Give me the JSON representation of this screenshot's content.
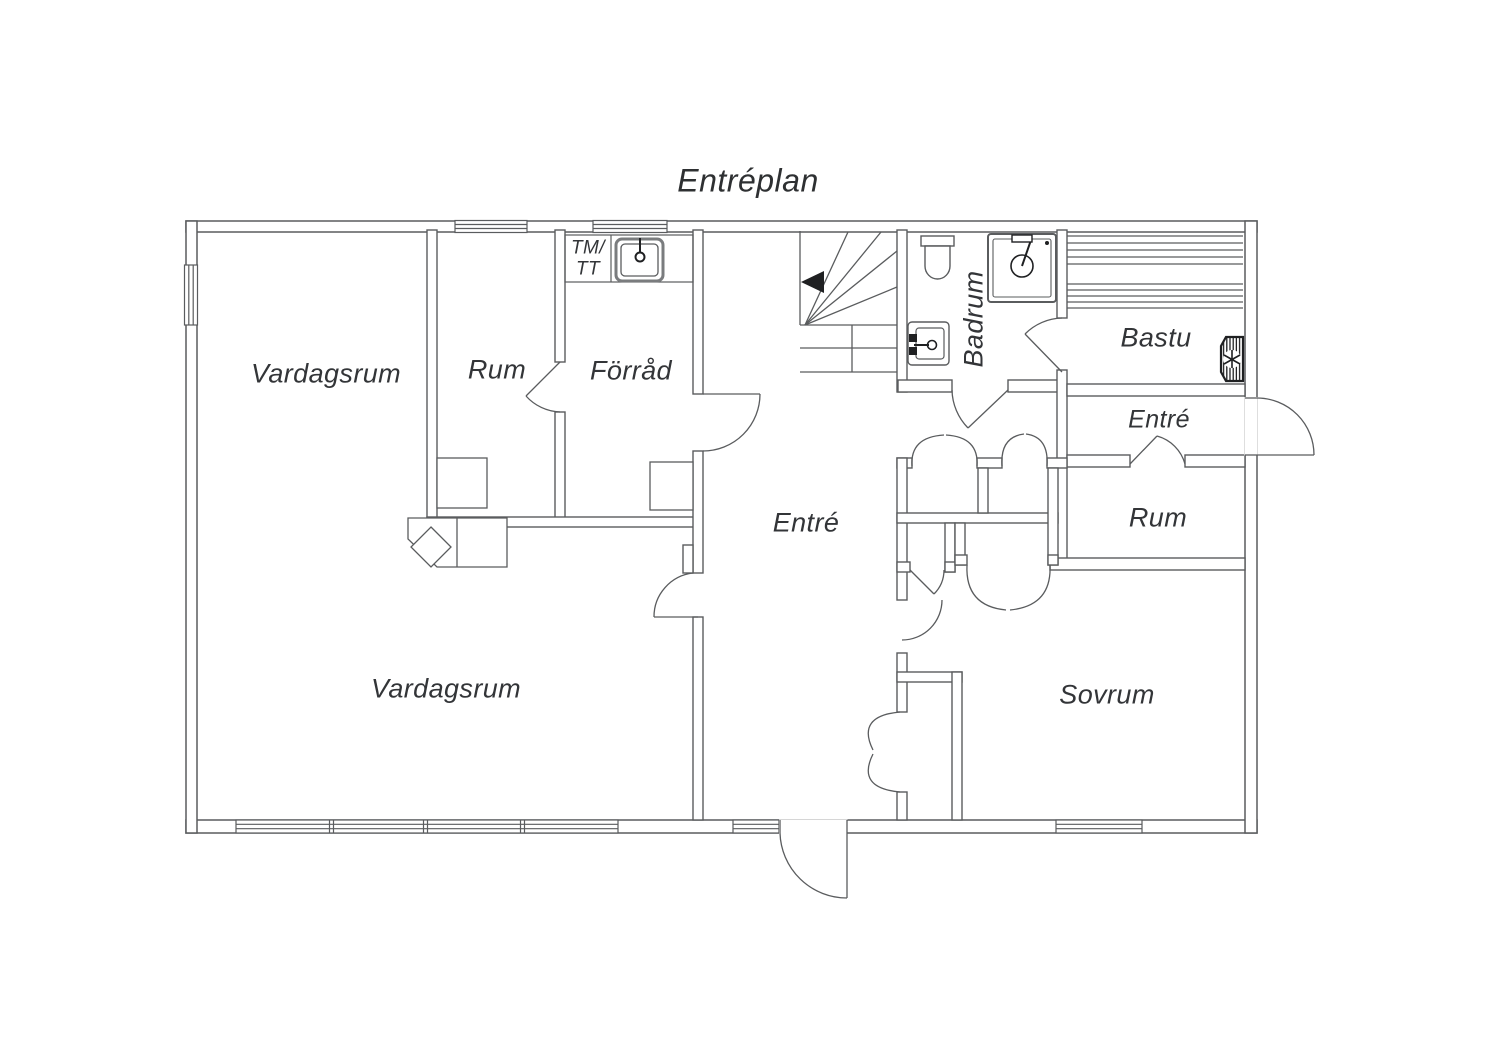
{
  "title": "Entréplan",
  "floor_plan": {
    "rooms": {
      "vardagsrum_upper": "Vardagsrum",
      "rum_upper": "Rum",
      "forrad": "Förråd",
      "tm_tt_line1": "TM/",
      "tm_tt_line2": "TT",
      "entre_main": "Entré",
      "badrum": "Badrum",
      "bastu": "Bastu",
      "entre_side": "Entré",
      "rum_side": "Rum",
      "vardagsrum_lower": "Vardagsrum",
      "sovrum": "Sovrum"
    },
    "fixtures": [
      "stairs",
      "stair-direction-arrow",
      "laundry-sink",
      "toilet",
      "shower",
      "washbasin",
      "sauna-benches",
      "sauna-heater",
      "fireplace",
      "closet-rum",
      "closet-forrad"
    ],
    "colors": {
      "wall_line": "#5a5c5e",
      "text": "#333538",
      "fixture_dark": "#1f2022",
      "background": "#ffffff"
    }
  }
}
